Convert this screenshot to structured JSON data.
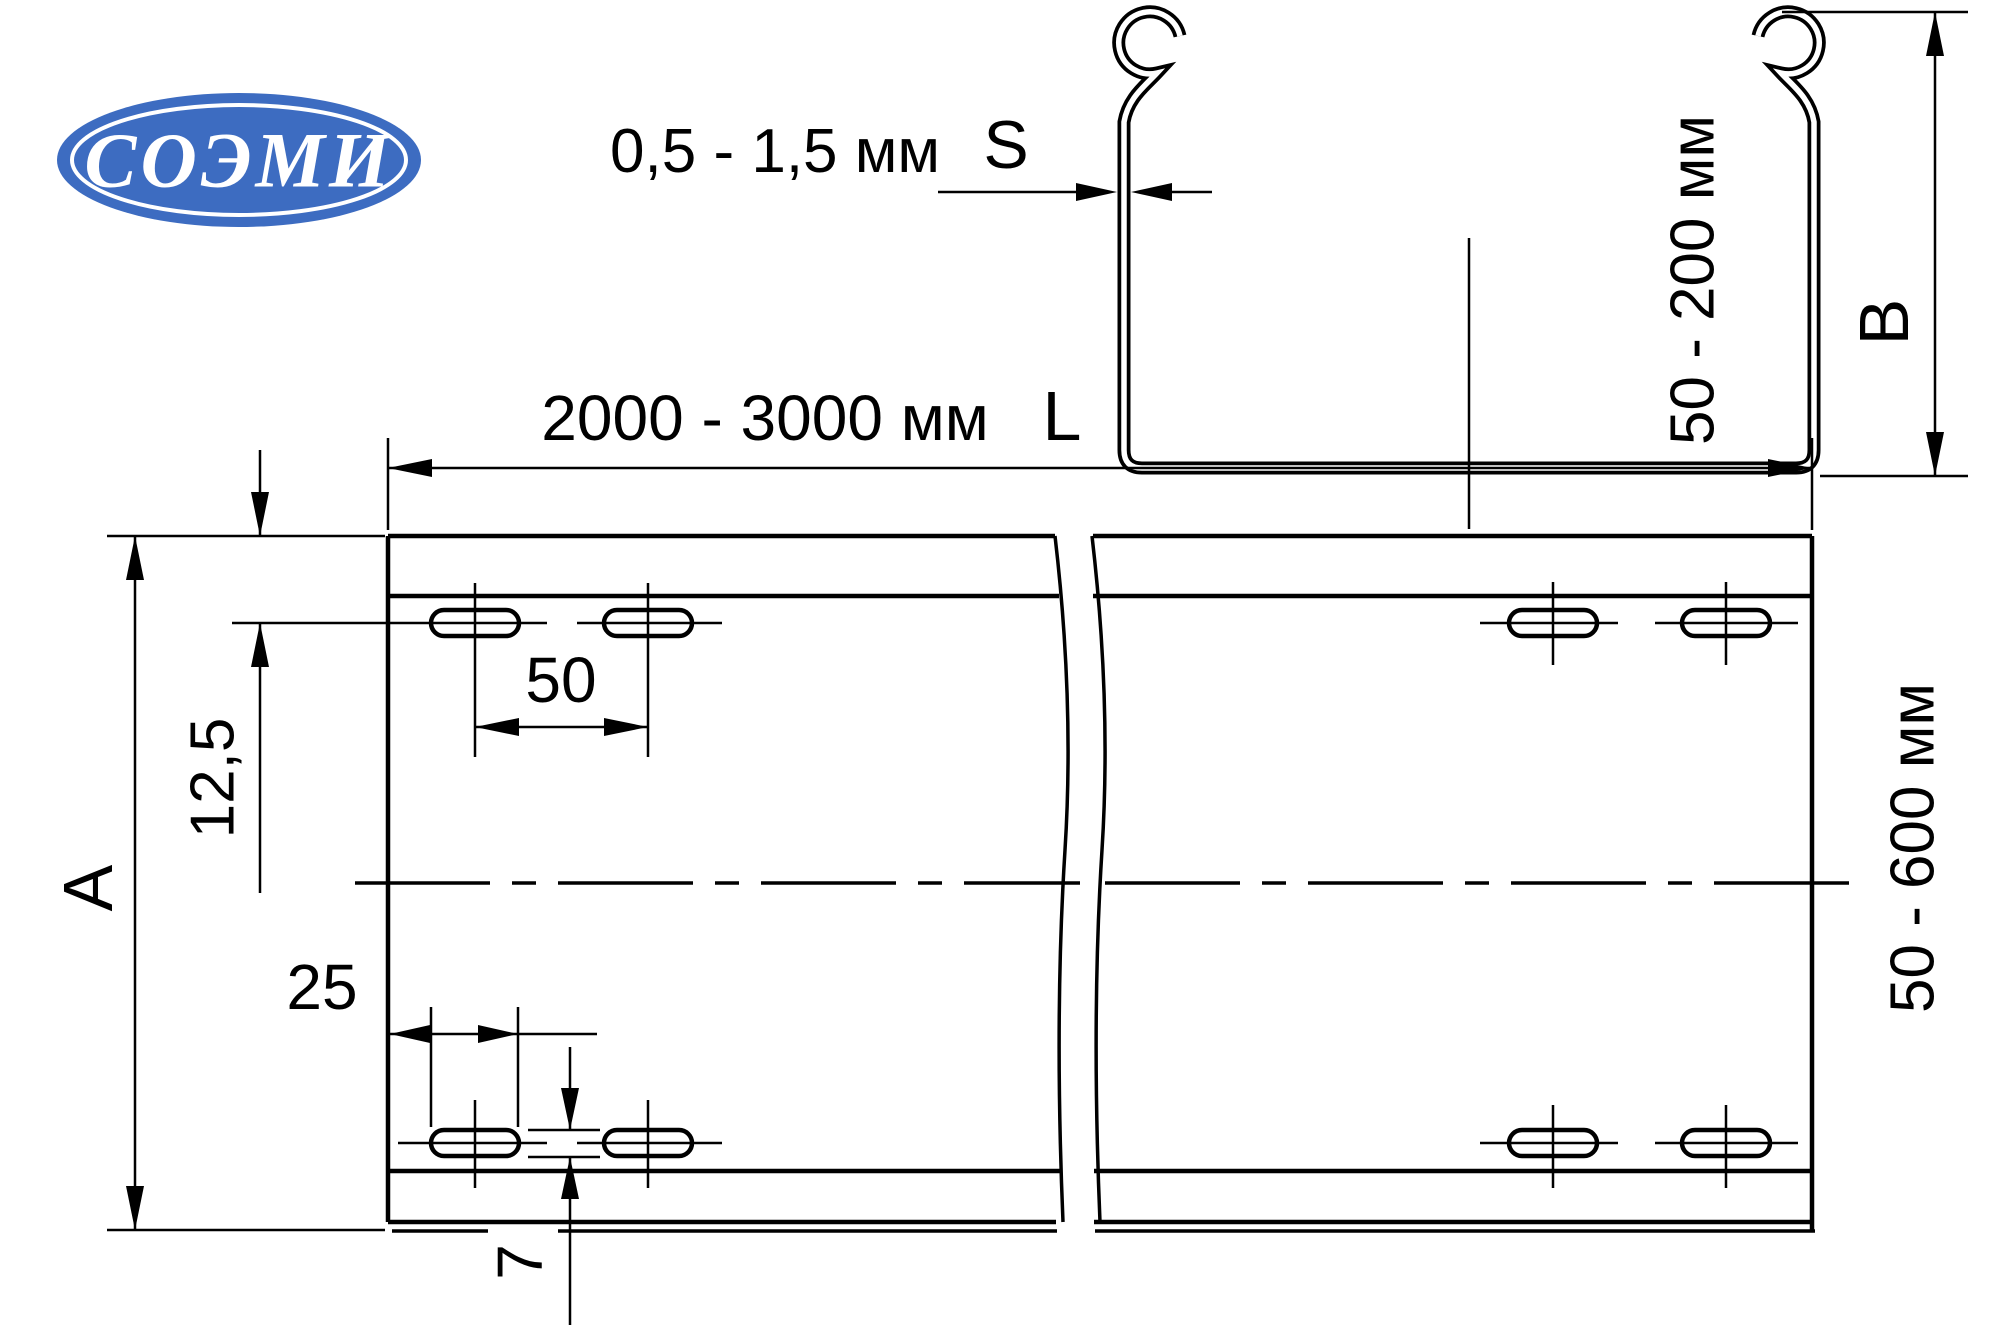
{
  "colors": {
    "background": "#ffffff",
    "line": "#000000",
    "logo_blue": "#3d6cc1",
    "logo_text": "#ffffff"
  },
  "logo": {
    "text": "СОЭМИ"
  },
  "cross_section_view": {
    "thickness_range": "0,5 - 1,5 мм",
    "thickness_symbol": "S",
    "height_range": "50 - 200 мм",
    "height_symbol": "B"
  },
  "plan_view": {
    "length_range": "2000 - 3000 мм",
    "length_symbol": "L",
    "width_symbol": "A",
    "width_range": "50 - 600 мм",
    "dim_edge_to_slots": "12,5",
    "dim_slot_spacing": "50",
    "dim_slot_length": "25",
    "dim_slot_width": "7"
  }
}
